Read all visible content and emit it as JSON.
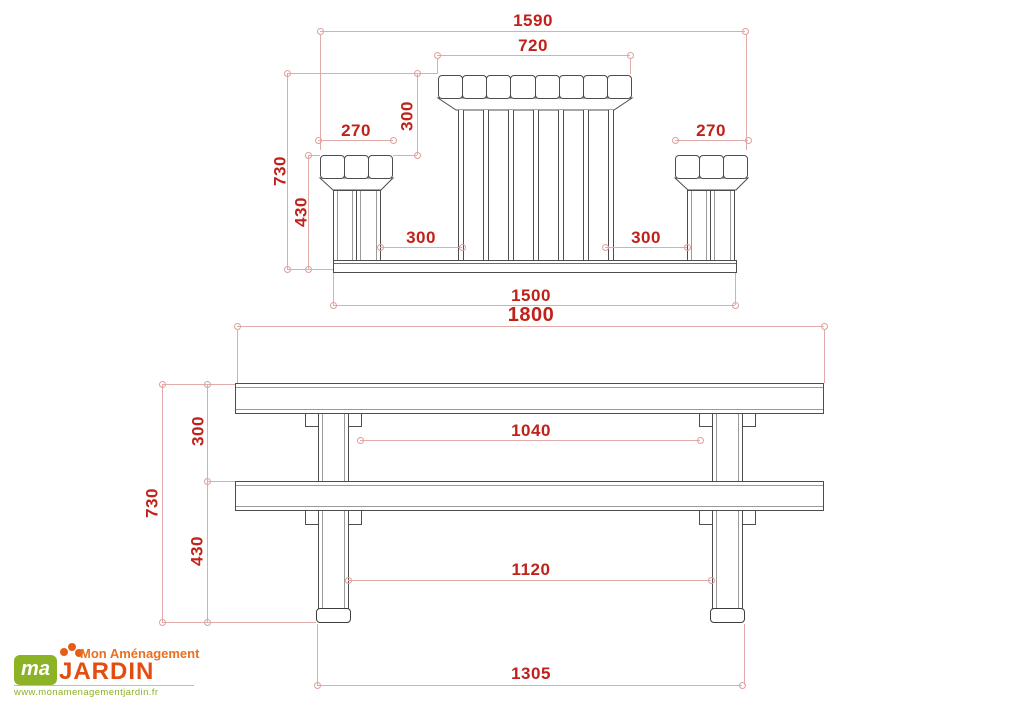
{
  "drawing": {
    "type": "technical-dimension-drawing",
    "subject": "picnic table with attached benches, front and side elevations",
    "units_implied": "mm"
  },
  "front_view": {
    "dims": {
      "overall_width": "1590",
      "tabletop_width": "720",
      "tabletop_to_seat": "300",
      "seat_width_left": "270",
      "seat_width_right": "270",
      "overall_height": "730",
      "seat_height": "430",
      "gap_left": "300",
      "gap_right": "300",
      "base_length": "1500"
    }
  },
  "side_view": {
    "dims": {
      "table_length": "1800",
      "tabletop_to_seat": "300",
      "overall_height": "730",
      "seat_height": "430",
      "inner_span_upper": "1040",
      "inner_span_lower": "1120",
      "foot_span": "1305"
    }
  },
  "logo": {
    "icon": "clover-icon",
    "monogram": "ma",
    "tagline": "Mon Aménagement",
    "name": "JARDIN",
    "website": "www.monamenagementjardin.fr"
  },
  "colors": {
    "dimension_text": "#c0211a",
    "dimension_line": "#e3aba8",
    "drawing_line": "#4d4d4d",
    "logo_green": "#8cb226",
    "logo_orange": "#e55e16"
  }
}
